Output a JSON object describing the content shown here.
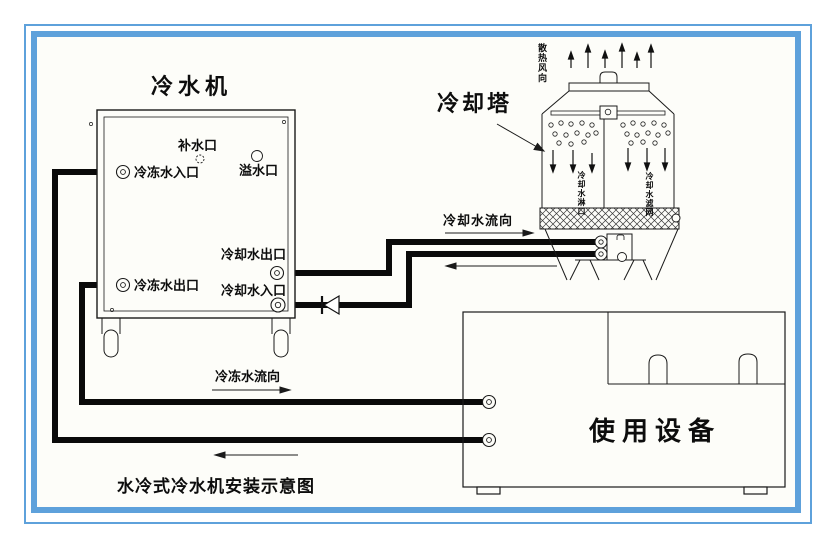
{
  "colors": {
    "frame_blue": "#5EA1DB",
    "ink": "#141414",
    "pipe_black": "#0a0a0a"
  },
  "chiller": {
    "title": "冷水机",
    "ports": {
      "makeup": "补水口",
      "overflow": "溢水口",
      "chilled_water_inlet": "冷冻水入口",
      "chilled_water_outlet": "冷冻水出口",
      "cooling_water_outlet": "冷却水出口",
      "cooling_water_inlet": "冷却水入口"
    }
  },
  "cooling_tower": {
    "title": "冷却塔",
    "air_flow_label": "散热风向",
    "spray_label": "冷却水淋口",
    "fill_label": "冷却水滤网"
  },
  "equipment": {
    "title": "使用设备"
  },
  "flows": {
    "cooling_water_direction": "冷却水流向",
    "chilled_water_direction": "冷冻水流向"
  },
  "caption": "水冷式冷水机安装示意图"
}
